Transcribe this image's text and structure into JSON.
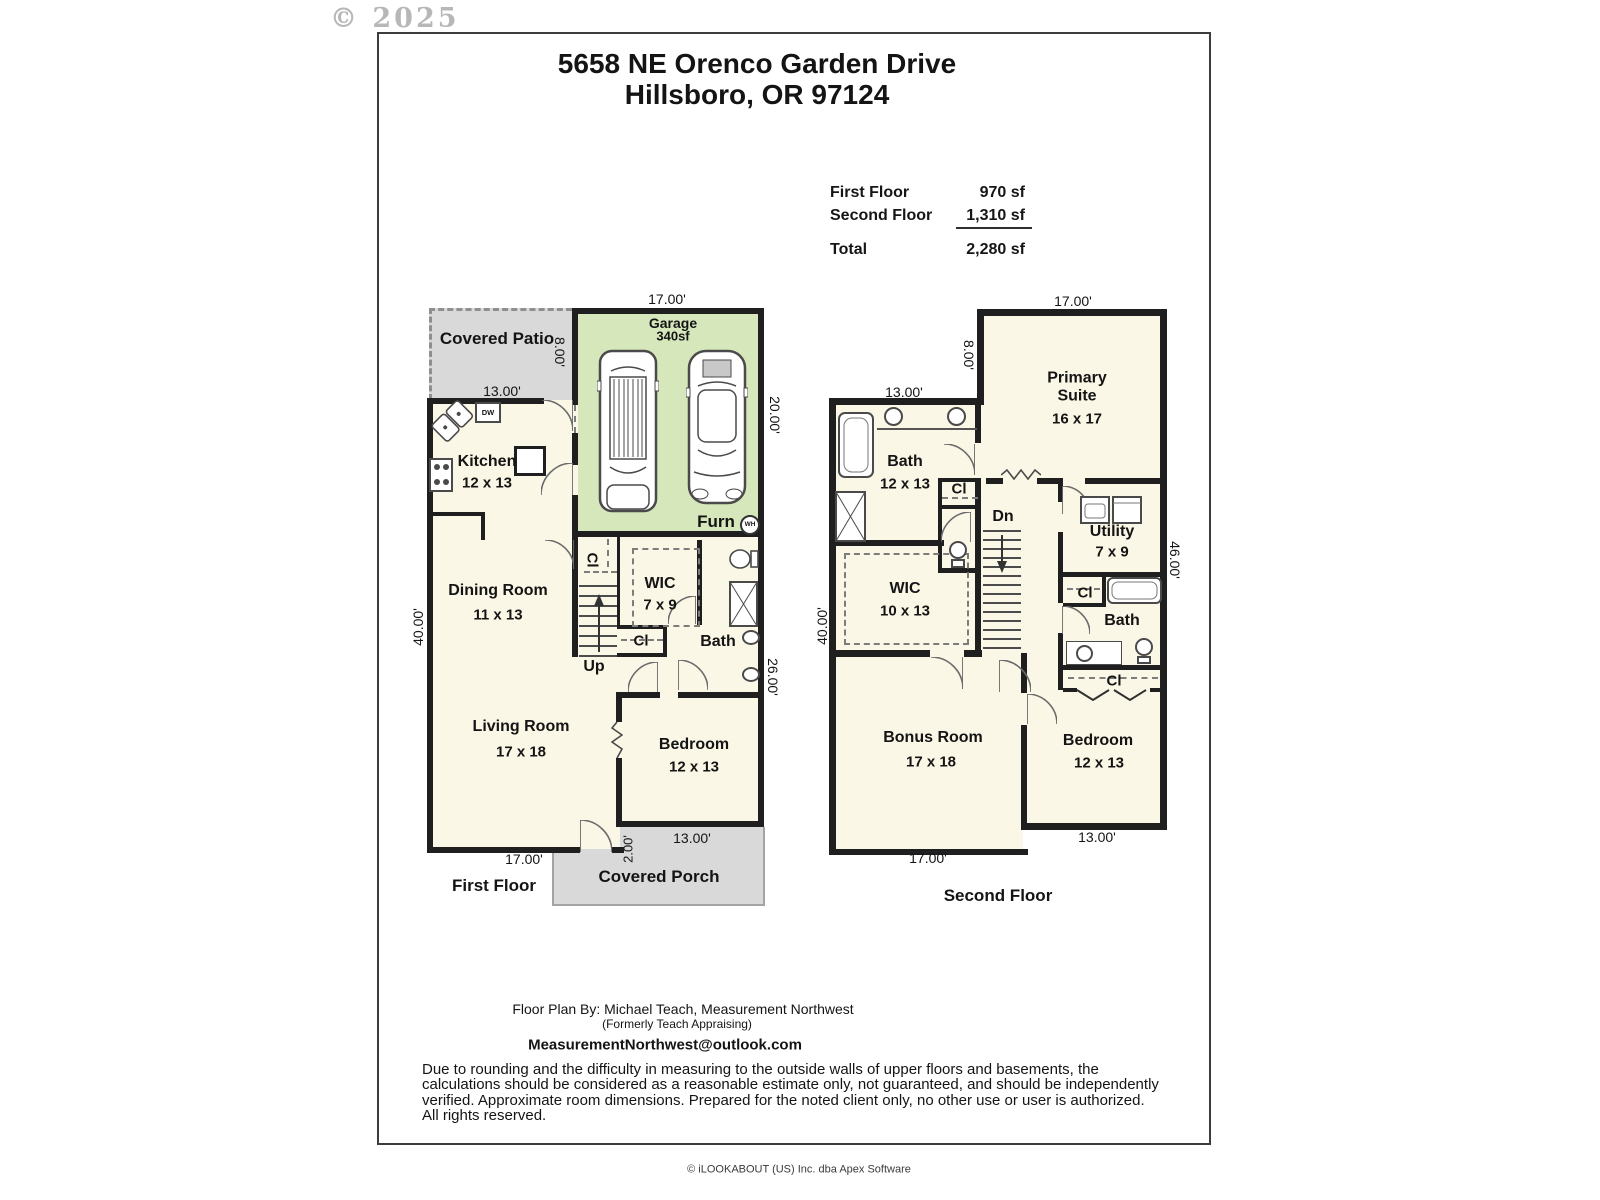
{
  "watermark": "© 2025",
  "title": {
    "line1": "5658 NE Orenco Garden Drive",
    "line2": "Hillsboro, OR 97124"
  },
  "summary": {
    "rows": [
      {
        "label": "First Floor",
        "value": "970 sf"
      },
      {
        "label": "Second Floor",
        "value": "1,310 sf"
      },
      {
        "label": "Total",
        "value": "2,280 sf"
      }
    ]
  },
  "floor1": {
    "caption": "First Floor",
    "patio": "Covered Patio",
    "porch": "Covered Porch",
    "garage_name": "Garage",
    "garage_area": "340sf",
    "furn": "Furn",
    "wh": "WH",
    "dw": "DW",
    "kitchen": "Kitchen",
    "kitchen_dims": "12 x 13",
    "dining": "Dining Room",
    "dining_dims": "11 x 13",
    "living": "Living Room",
    "living_dims": "17 x 18",
    "bedroom": "Bedroom",
    "bedroom_dims": "12 x 13",
    "wic": "WIC",
    "wic_dims": "7 x 9",
    "bath": "Bath",
    "up": "Up",
    "cl": "Cl",
    "dim_garage_w": "17.00'",
    "dim_patio_h": "8.00'",
    "dim_patio_w": "13.00'",
    "dim_garage_d": "20.00'",
    "dim_left": "40.00'",
    "dim_right": "26.00'",
    "dim_bottom": "17.00'",
    "dim_porch_w": "13.00'",
    "dim_porch_d": "2.00'"
  },
  "floor2": {
    "caption": "Second Floor",
    "primary": "Primary Suite",
    "primary_dims": "16 x 17",
    "bath1": "Bath",
    "bath1_dims": "12 x 13",
    "wic": "WIC",
    "wic_dims": "10 x 13",
    "utility": "Utility",
    "utility_dims": "7 x 9",
    "bath2": "Bath",
    "bonus": "Bonus Room",
    "bonus_dims": "17 x 18",
    "bedroom": "Bedroom",
    "bedroom_dims": "12 x 13",
    "dn": "Dn",
    "cl": "Cl",
    "dim_top": "17.00'",
    "dim_left_upper": "8.00'",
    "dim_bath_w": "13.00'",
    "dim_left": "40.00'",
    "dim_right": "46.00'",
    "dim_bottom_left": "17.00'",
    "dim_bottom_right": "13.00'"
  },
  "footer": {
    "byline": "Floor Plan By: Michael Teach, Measurement Northwest",
    "formerly": "(Formerly Teach Appraising)",
    "email": "MeasurementNorthwest@outlook.com",
    "disclaimer": "Due to rounding and the difficulty in measuring to the outside walls of upper floors and basements, the calculations should be considered as a reasonable estimate only, not guaranteed, and should be independently verified. Approximate room dimensions. Prepared for the noted client only, no other use or user is authorized. All rights reserved.",
    "provider": "© iLOOKABOUT (US) Inc. dba Apex Software"
  }
}
